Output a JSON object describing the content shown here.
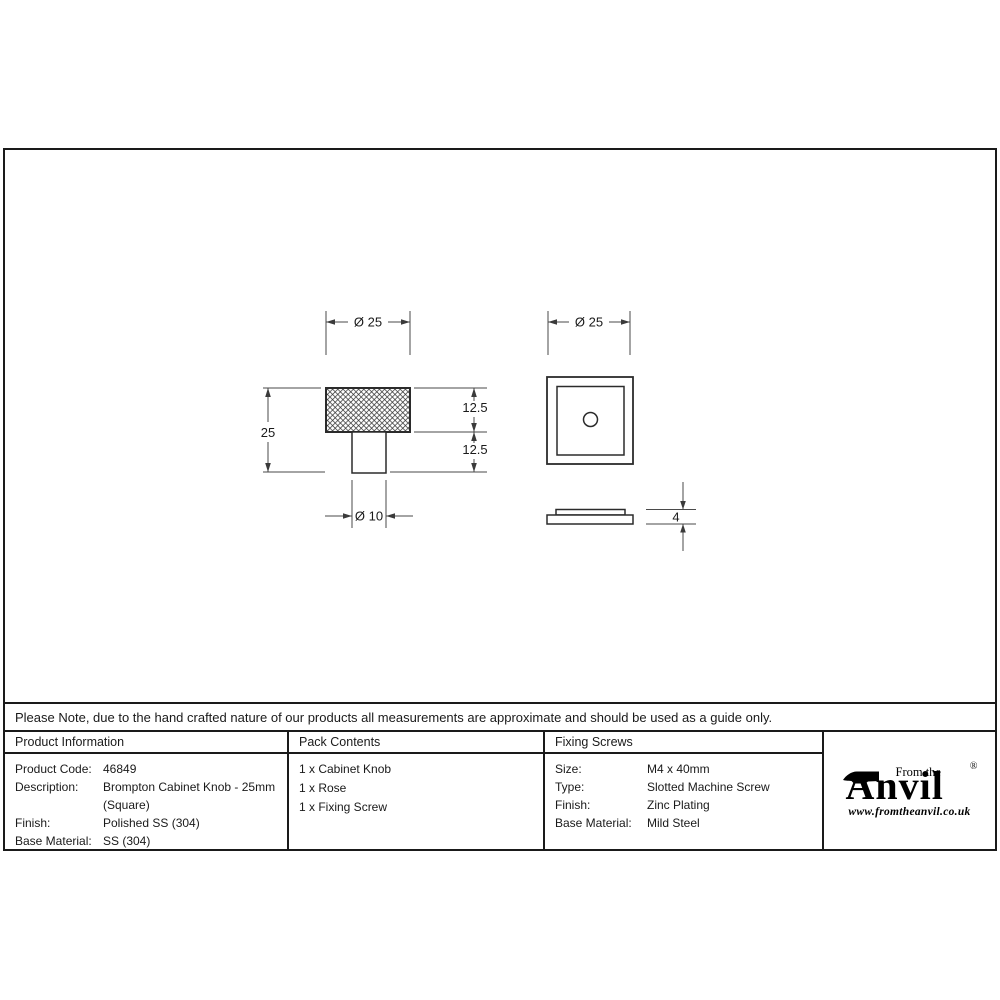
{
  "note": {
    "text": "Please Note, due to the hand crafted nature of our products all measurements are approximate and should be used as a guide only."
  },
  "drawing": {
    "front_view": {
      "width_dim": "Ø 25",
      "height_dim": "25",
      "head_height_dim": "12.5",
      "stem_height_dim": "12.5",
      "stem_width_dim": "Ø 10"
    },
    "rose_top_view": {
      "width_dim": "Ø 25"
    },
    "rose_side_view": {
      "thickness_dim": "4"
    }
  },
  "table": {
    "product_information": {
      "header": "Product Information",
      "rows": [
        {
          "label": "Product Code:",
          "value": "46849"
        },
        {
          "label": "Description:",
          "value": "Brompton Cabinet Knob - 25mm (Square)"
        },
        {
          "label": "Finish:",
          "value": "Polished SS (304)"
        },
        {
          "label": "Base Material:",
          "value": "SS (304)"
        }
      ]
    },
    "pack_contents": {
      "header": "Pack Contents",
      "items": [
        "1 x Cabinet Knob",
        "1 x Rose",
        "1 x Fixing Screw"
      ]
    },
    "fixing_screws": {
      "header": "Fixing Screws",
      "rows": [
        {
          "label": "Size:",
          "value": "M4 x 40mm"
        },
        {
          "label": "Type:",
          "value": "Slotted Machine Screw"
        },
        {
          "label": "Finish:",
          "value": "Zinc Plating"
        },
        {
          "label": "Base Material:",
          "value": "Mild Steel"
        }
      ]
    }
  },
  "logo": {
    "prefix": "From the",
    "brand": "Anvil",
    "registered": "®",
    "website": "www.fromtheanvil.co.uk"
  }
}
